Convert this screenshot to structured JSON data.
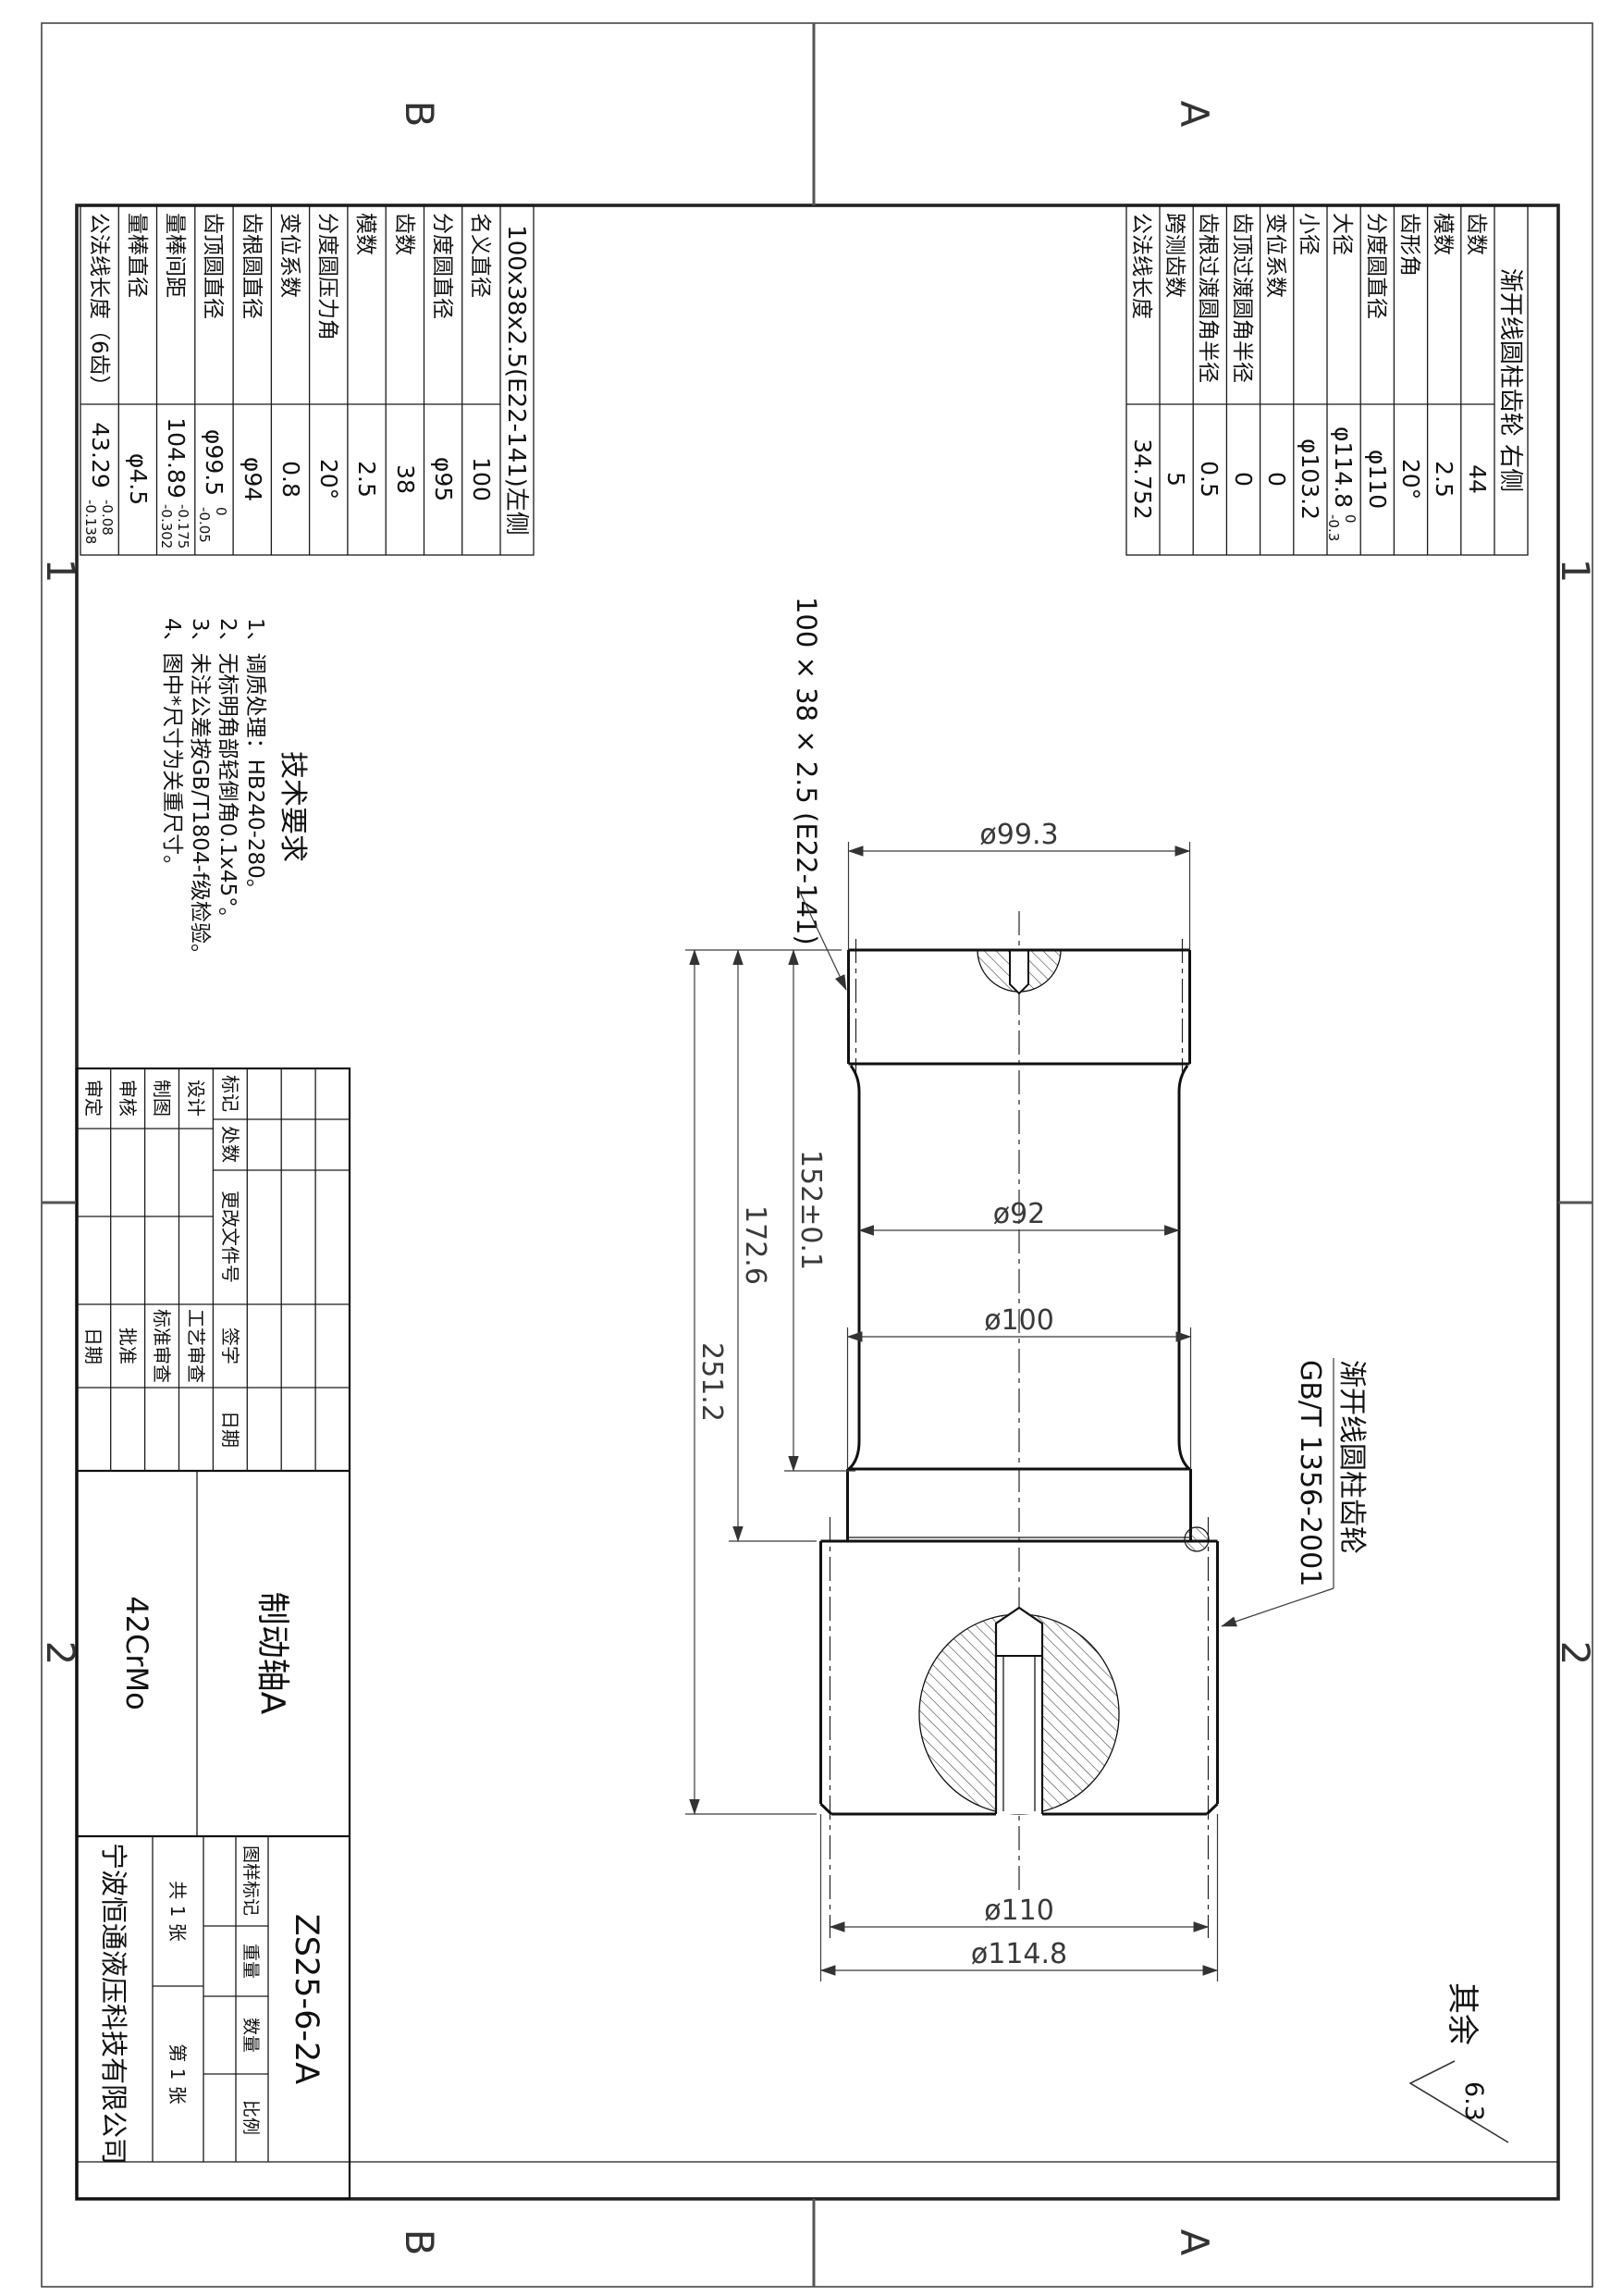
{
  "sheet": {
    "zone_letter_a": "A",
    "zone_letter_b": "B",
    "zone_num_1": "1",
    "zone_num_2": "2"
  },
  "gear_table_right": {
    "title": "渐开线圆柱齿轮 右侧",
    "rows": [
      {
        "label": "齿数",
        "value": "44"
      },
      {
        "label": "模数",
        "value": "2.5"
      },
      {
        "label": "齿形角",
        "value": "20°"
      },
      {
        "label": "分度圆直径",
        "value": "φ110"
      },
      {
        "label": "大径",
        "value": "φ114.8",
        "sup": "0",
        "sub": "-0.3"
      },
      {
        "label": "小径",
        "value": "φ103.2"
      },
      {
        "label": "变位系数",
        "value": "0"
      },
      {
        "label": "齿顶过渡圆角半径",
        "value": "0"
      },
      {
        "label": "齿根过渡圆角半径",
        "value": "0.5"
      },
      {
        "label": "跨测齿数",
        "value": "5"
      },
      {
        "label": "公法线长度",
        "value": "34.752"
      }
    ]
  },
  "gear_table_left": {
    "title": "100x38x2.5(E22-141)左侧",
    "rows": [
      {
        "label": "名义直径",
        "value": "100"
      },
      {
        "label": "分度圆直径",
        "value": "φ95"
      },
      {
        "label": "齿数",
        "value": "38"
      },
      {
        "label": "模数",
        "value": "2.5"
      },
      {
        "label": "分度圆压力角",
        "value": "20°"
      },
      {
        "label": "变位系数",
        "value": "0.8"
      },
      {
        "label": "齿根圆直径",
        "value": "φ94"
      },
      {
        "label": "齿顶圆直径",
        "value": "φ99.5",
        "sup": "0",
        "sub": "-0.05"
      },
      {
        "label": "量棒间距",
        "value": "104.89",
        "sup": "-0.175",
        "sub": "-0.302"
      },
      {
        "label": "量棒直径",
        "value": "φ4.5"
      },
      {
        "label": "公法线长度（6齿）",
        "value": "43.29",
        "sup": "-0.08",
        "sub": "-0.138"
      }
    ]
  },
  "tech": {
    "title": "技术要求",
    "lines": [
      "1、调质处理：HB240-280。",
      "2、无标明角部轻倒角0.1x45°。",
      "3、未注公差按GB/T1804-f级检验。",
      "4、图中*尺寸为关重尺寸。"
    ]
  },
  "dims": {
    "dia_top": "ø99.3",
    "dia_mid": "ø92",
    "dia_collar": "ø100",
    "dia_pitch": "ø110",
    "dia_tip": "ø114.8",
    "len_152": "152±0.1",
    "len_172": "172.6",
    "len_251": "251.2"
  },
  "annotations": {
    "spline_leader": "100 × 38 × 2.5 (E22-141)",
    "gear_name": "渐开线圆柱齿轮",
    "gear_std": "GB/T 1356-2001",
    "rest": "其余",
    "roughness": "6.3"
  },
  "title_block": {
    "rev_headers": [
      "标记",
      "处数",
      "更改文件号",
      "签字",
      "日期"
    ],
    "rev_rows": [
      [
        "设计",
        "工艺审查"
      ],
      [
        "制图",
        "标准审查"
      ],
      [
        "审核",
        "批准"
      ],
      [
        "审定",
        "日期"
      ]
    ],
    "part_name": "制动轴A",
    "material": "42CrMo",
    "drawing_no": "ZS25-6-2A",
    "stamp_headers": [
      "图样标记",
      "重量",
      "数量",
      "比例"
    ],
    "sheet_total": "共 1 张",
    "sheet_no": "第 1 张",
    "company": "宁波恒通液压科技有限公司"
  }
}
